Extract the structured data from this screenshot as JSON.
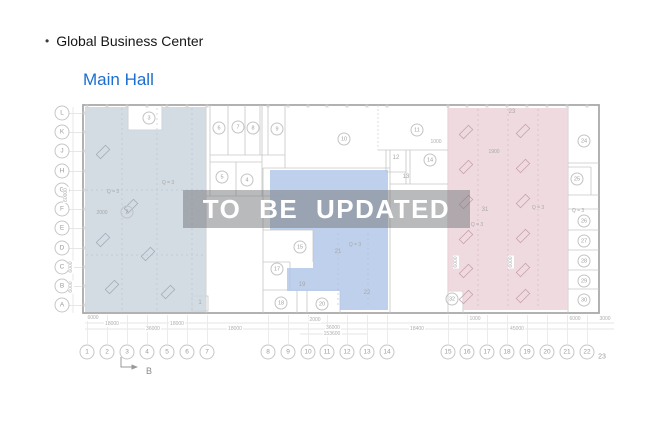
{
  "header": {
    "bullet": "•",
    "title": "Global Business Center"
  },
  "section": {
    "title": "Main Hall"
  },
  "watermark": {
    "text": "TO BE UPDATED"
  },
  "colors": {
    "accent": "#1b6ed2",
    "region_left": "#cbd5de",
    "region_mid": "#b3c8e8",
    "region_right": "#ecd3da",
    "banner_bg": "rgba(115,117,122,0.5)",
    "banner_text": "#ffffff",
    "wall": "#a9a9a9"
  },
  "axes": {
    "rows": [
      {
        "label": "L",
        "y": 113
      },
      {
        "label": "K",
        "y": 132
      },
      {
        "label": "J",
        "y": 151
      },
      {
        "label": "H",
        "y": 171
      },
      {
        "label": "G",
        "y": 190
      },
      {
        "label": "F",
        "y": 209
      },
      {
        "label": "E",
        "y": 228
      },
      {
        "label": "D",
        "y": 248
      },
      {
        "label": "C",
        "y": 267
      },
      {
        "label": "B",
        "y": 286
      },
      {
        "label": "A",
        "y": 305
      }
    ],
    "cols": [
      {
        "label": "1",
        "x": 87
      },
      {
        "label": "2",
        "x": 107
      },
      {
        "label": "3",
        "x": 127
      },
      {
        "label": "4",
        "x": 147
      },
      {
        "label": "5",
        "x": 167
      },
      {
        "label": "6",
        "x": 187
      },
      {
        "label": "7",
        "x": 207
      },
      {
        "label": "8",
        "x": 268
      },
      {
        "label": "9",
        "x": 288
      },
      {
        "label": "10",
        "x": 308
      },
      {
        "label": "11",
        "x": 327
      },
      {
        "label": "12",
        "x": 347
      },
      {
        "label": "13",
        "x": 367
      },
      {
        "label": "14",
        "x": 387
      },
      {
        "label": "15",
        "x": 448
      },
      {
        "label": "16",
        "x": 467
      },
      {
        "label": "17",
        "x": 487
      },
      {
        "label": "18",
        "x": 507
      },
      {
        "label": "19",
        "x": 527
      },
      {
        "label": "20",
        "x": 547
      },
      {
        "label": "21",
        "x": 567
      },
      {
        "label": "22",
        "x": 587
      },
      {
        "label": "23",
        "x": 602,
        "plain": true
      }
    ]
  },
  "rooms": [
    {
      "n": "2",
      "x": 127,
      "y": 212
    },
    {
      "n": "3",
      "x": 149,
      "y": 118
    },
    {
      "n": "4",
      "x": 247,
      "y": 180
    },
    {
      "n": "5",
      "x": 222,
      "y": 177
    },
    {
      "n": "6",
      "x": 219,
      "y": 128
    },
    {
      "n": "7",
      "x": 238,
      "y": 127
    },
    {
      "n": "8",
      "x": 253,
      "y": 128
    },
    {
      "n": "9",
      "x": 277,
      "y": 129
    },
    {
      "n": "10",
      "x": 344,
      "y": 139
    },
    {
      "n": "11",
      "x": 417,
      "y": 130
    },
    {
      "n": "14",
      "x": 430,
      "y": 160
    },
    {
      "n": "15",
      "x": 300,
      "y": 247
    },
    {
      "n": "17",
      "x": 277,
      "y": 269
    },
    {
      "n": "18",
      "x": 281,
      "y": 303
    },
    {
      "n": "20",
      "x": 322,
      "y": 304
    },
    {
      "n": "24",
      "x": 584,
      "y": 141
    },
    {
      "n": "25",
      "x": 577,
      "y": 179
    },
    {
      "n": "26",
      "x": 584,
      "y": 221
    },
    {
      "n": "27",
      "x": 584,
      "y": 241
    },
    {
      "n": "28",
      "x": 584,
      "y": 261
    },
    {
      "n": "29",
      "x": 584,
      "y": 281
    },
    {
      "n": "30",
      "x": 584,
      "y": 300
    },
    {
      "n": "32",
      "x": 452,
      "y": 299
    }
  ],
  "annotations": [
    {
      "t": "Q = 3",
      "x": 113,
      "y": 192
    },
    {
      "t": "Q = 3",
      "x": 168,
      "y": 183
    },
    {
      "t": "Q = 3",
      "x": 355,
      "y": 245
    },
    {
      "t": "Q = 3",
      "x": 477,
      "y": 225
    },
    {
      "t": "Q = 3",
      "x": 538,
      "y": 208
    },
    {
      "t": "Q = 3",
      "x": 578,
      "y": 211
    },
    {
      "t": "2000",
      "x": 102,
      "y": 213
    },
    {
      "t": "1900",
      "x": 494,
      "y": 152
    },
    {
      "t": "23",
      "x": 512,
      "y": 112,
      "size": 6
    },
    {
      "t": "31",
      "x": 485,
      "y": 210,
      "size": 6
    },
    {
      "t": "12",
      "x": 396,
      "y": 158,
      "size": 6
    },
    {
      "t": "13",
      "x": 406,
      "y": 177,
      "size": 6
    },
    {
      "t": "19",
      "x": 302,
      "y": 285,
      "size": 6
    },
    {
      "t": "21",
      "x": 338,
      "y": 252,
      "size": 6
    },
    {
      "t": "22",
      "x": 367,
      "y": 293,
      "size": 6
    },
    {
      "t": "1",
      "x": 200,
      "y": 303,
      "size": 6
    },
    {
      "t": "B",
      "x": 149,
      "y": 371,
      "size": 9,
      "color": "#8a8a8a"
    }
  ],
  "dimensions": [
    {
      "t": "6000",
      "x": 93,
      "y": 318
    },
    {
      "t": "18000",
      "x": 112,
      "y": 324
    },
    {
      "t": "36000",
      "x": 153,
      "y": 329
    },
    {
      "t": "18000",
      "x": 177,
      "y": 324
    },
    {
      "t": "18000",
      "x": 235,
      "y": 329
    },
    {
      "t": "2000",
      "x": 315,
      "y": 320
    },
    {
      "t": "36000",
      "x": 333,
      "y": 328
    },
    {
      "t": "153600",
      "x": 332,
      "y": 334
    },
    {
      "t": "1000",
      "x": 475,
      "y": 319
    },
    {
      "t": "18400",
      "x": 417,
      "y": 329
    },
    {
      "t": "45000",
      "x": 517,
      "y": 329
    },
    {
      "t": "6000",
      "x": 575,
      "y": 319
    },
    {
      "t": "3000",
      "x": 605,
      "y": 319
    },
    {
      "t": "1000",
      "x": 436,
      "y": 142
    },
    {
      "t": "60000",
      "x": 66,
      "y": 195,
      "r": -90
    },
    {
      "t": "6000",
      "x": 71,
      "y": 267,
      "r": -90
    },
    {
      "t": "6000",
      "x": 71,
      "y": 287,
      "r": -90
    },
    {
      "t": "6000",
      "x": 456,
      "y": 262,
      "r": -90
    },
    {
      "t": "6000",
      "x": 511,
      "y": 262,
      "r": -90
    }
  ]
}
